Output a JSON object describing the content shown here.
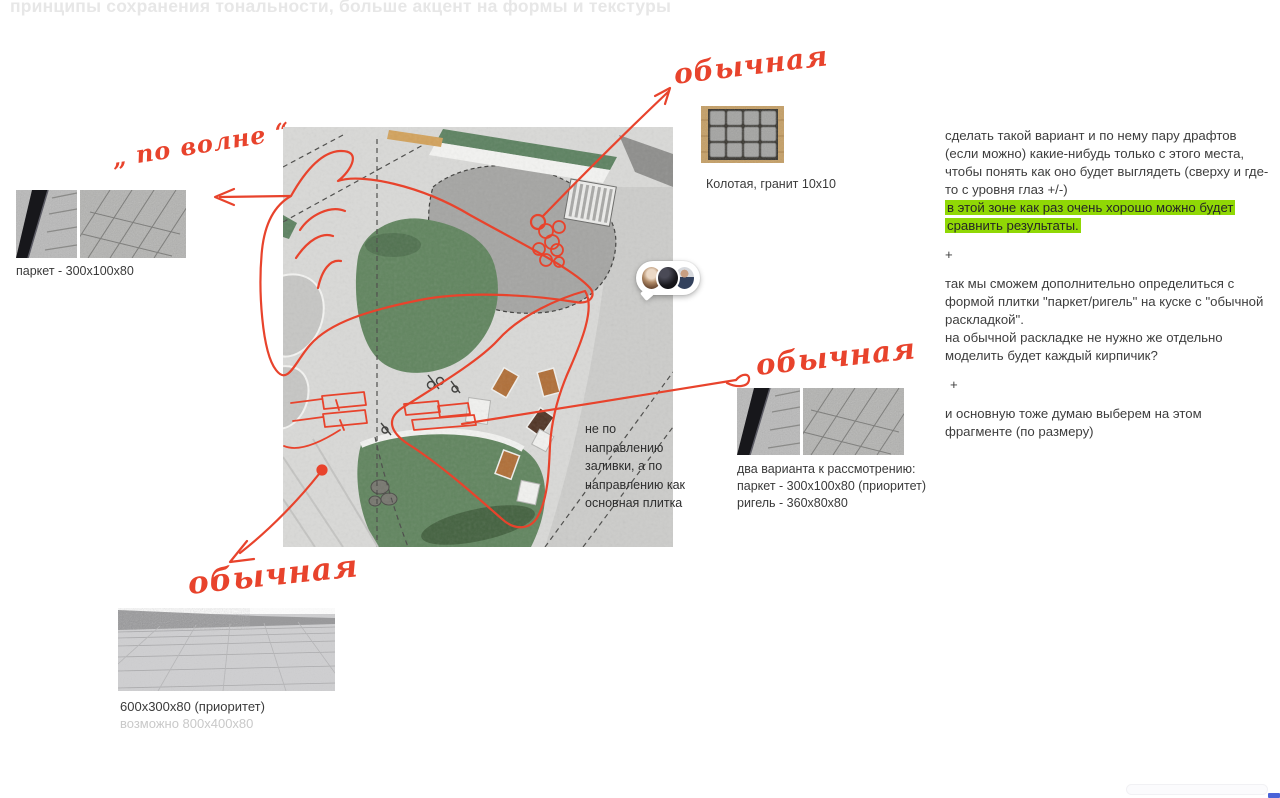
{
  "title": {
    "text": "принципы сохранения тональности, больше акцент на формы и текстуры"
  },
  "handwritten": {
    "po_volne": "„ по волне “",
    "obychnaya_top": "обычная",
    "obychnaya_mid": "обычная",
    "obychnaya_bottom": "обычная"
  },
  "left_swatch": {
    "label": "паркет - 300x100x80"
  },
  "kolotaya": {
    "label": "Колотая, гранит 10х10"
  },
  "variants": {
    "line1": "два варианта к рассмотрению:",
    "line2": "паркет - 300x100x80 (приоритет)",
    "line3": "ригель - 360x80x80"
  },
  "bottom_swatch": {
    "label_primary": "600x300x80 (приоритет)",
    "label_secondary": "возможно 800x400x80"
  },
  "plan": {
    "note": "не по направлению заливки, а по направлению как основная плитка"
  },
  "comments": {
    "para1": "сделать такой вариант и по нему пару драфтов (если можно) какие-нибудь только с этого места, чтобы понять как оно будет выглядеть (сверху и где-то с уровня глаз +/-)",
    "highlight": "в этой зоне как раз очень хорошо можно будет сравнить результаты.",
    "plus1": "+",
    "para2": "так мы сможем дополнительно определиться с формой плитки \"паркет/ригель\"  на куске с \"обычной раскладкой\".",
    "para3": "на обычной раскладке не нужно же отдельно моделить будет каждый кирпичик?",
    "plus2": "+",
    "para4": "и основную тоже думаю выберем на этом фрагменте (по размеру)"
  },
  "colors": {
    "annotation_red": "#e8432c",
    "highlight_green": "#90d805",
    "faded_title_gray": "#e7e7e7",
    "text_dark": "#3e3e3e",
    "text_muted": "#c9c9c9"
  },
  "icons": {
    "avatar_group": "collaborator-avatars",
    "scrollbar": "horizontal-scrollbar"
  }
}
